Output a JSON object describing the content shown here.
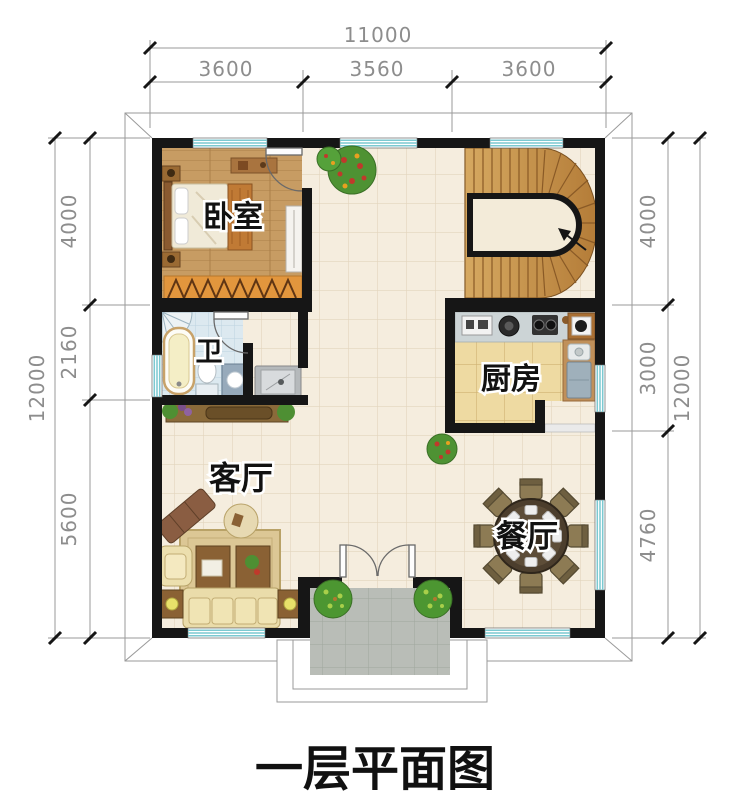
{
  "title": "一层平面图",
  "rooms": {
    "bedroom": "卧室",
    "bathroom": "卫",
    "kitchen": "厨房",
    "living_room": "客厅",
    "dining_room": "餐厅"
  },
  "dimensions": {
    "top": {
      "total": "11000",
      "segments": [
        "3600",
        "3560",
        "3600"
      ]
    },
    "left": {
      "total": "12000",
      "segments": [
        "4000",
        "2160",
        "5600"
      ]
    },
    "right": {
      "total": "12000",
      "segments": [
        "4000",
        "3000",
        "4760"
      ]
    }
  },
  "colors": {
    "wall": "#161616",
    "window_stripe": "#7cc9d1",
    "tile_floor": "#f5edde",
    "wood_floor": "#c79c63",
    "stair_wood": "#c6954f",
    "bath_tile": "#dce9f0",
    "kitchen_tile": "#eedaa2",
    "porch_tile": "#b9bdb7",
    "dimension_text": "#8d8d8d"
  }
}
